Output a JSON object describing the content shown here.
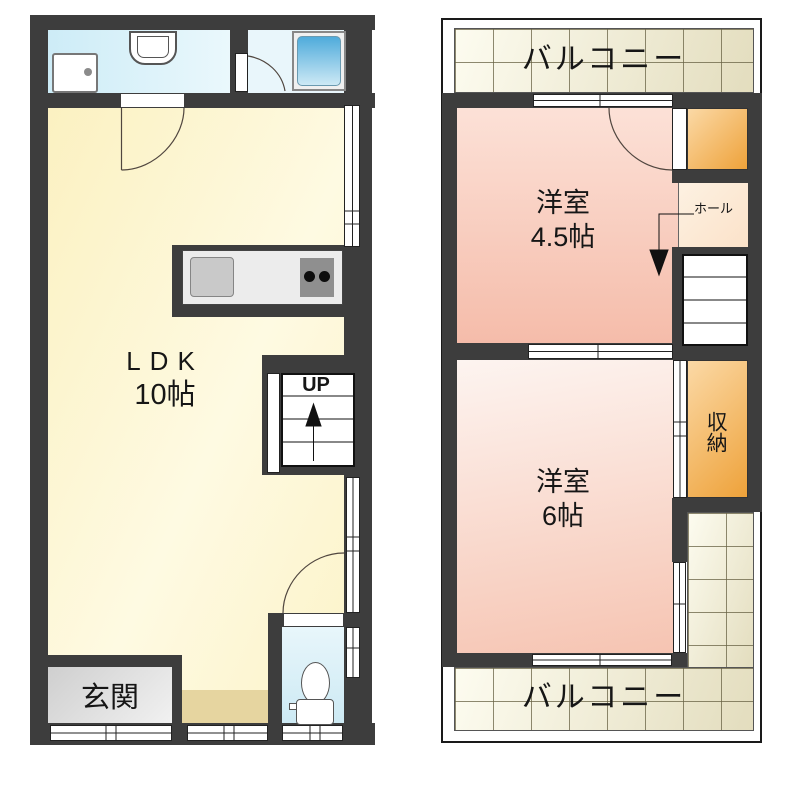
{
  "floor1": {
    "ldk_label": "LDK",
    "ldk_size": "10帖",
    "entrance_label": "玄関",
    "stairs_up_label": "UP"
  },
  "floor2": {
    "balcony_top_label": "バルコニー",
    "balcony_bottom_label": "バルコニー",
    "room_45_name": "洋室",
    "room_45_size": "4.5帖",
    "room_6_name": "洋室",
    "room_6_size": "6帖",
    "closet_label": "収納",
    "hall_label": "ホール"
  },
  "colors": {
    "wall": "#3d3d3d",
    "ldk_floor": "#fbf1c1",
    "sanitary_floor": "#d6eff8",
    "bathtub": "#4fabdb",
    "room_pink": "#f5bcaa",
    "room_pink_light": "#f6c4b2",
    "hall_peach": "#fbe2c9",
    "closet_orange": "#eea23a",
    "balcony_tile": "#e3ddbe",
    "entrance_gray": "#d2d2d2",
    "step_tan": "#e6d5a0",
    "counter_gray": "#ececec"
  }
}
